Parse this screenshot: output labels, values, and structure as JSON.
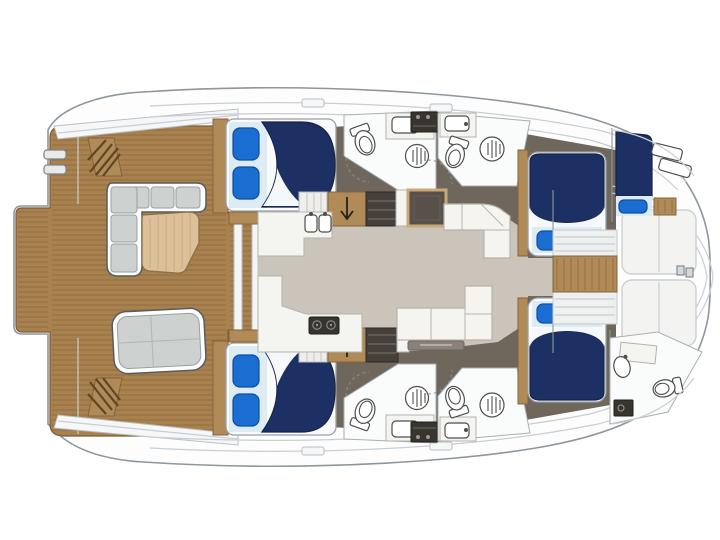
{
  "title": "Catamaran yacht interior deck plan (top view, bow to the right)",
  "colors": {
    "background": "#ffffff",
    "outline": "#8d969c",
    "hull-white": "#fdfdfd",
    "deck-line": "#c9ced2",
    "teak": "#a9814f",
    "teak-edge": "#7d5c33",
    "teak-line": "#6f5530",
    "salon-floor": "#cac4bb",
    "hull-floor": "#6f665c",
    "bath-floor": "#fafbfb",
    "wall-line": "#a9afb3",
    "fixture": "#4e4e4c",
    "counter": "#f4f4f0",
    "counter-edge": "#b4b4ad",
    "sofa-white": "#f5f4ef",
    "sofa-edge": "#b5b5ae",
    "cushion-gray": "#cdd1d0",
    "cushion-edge": "#9aa0a0",
    "frame-dark": "#585c5e",
    "navy": "#1d3063",
    "navy-edge": "#142348",
    "sheet": "#ddebf4",
    "sheet-fold": "#f4f8fb",
    "pillow": "#1a6ed2",
    "pillow-edge": "#0d4da0",
    "tan": "#b08a57",
    "tan-edge": "#84633a",
    "dark-shelf": "#46403a",
    "appliance": "#38352f",
    "bed-base": "#f8fafb",
    "bed-edge": "#98a0a5",
    "door-arc": "#8a9095",
    "tramp": "#f3f4f2",
    "tramp-edge": "#cbd0d2",
    "step-line": "#5e4724",
    "wood-table": "#dcc09a",
    "wood-table-edge": "#8a7046",
    "table-top": "#57514a",
    "table-frame": "#c9a877"
  },
  "plan": {
    "areas": [
      "aft-deck",
      "swim-platform",
      "cockpit-lounge",
      "salon",
      "galley",
      "port-aft-cabin",
      "port-aft-head",
      "port-fwd-head",
      "port-fwd-cabin",
      "starboard-aft-cabin",
      "starboard-aft-head",
      "starboard-fwd-head",
      "starboard-fwd-cabin",
      "forepeak-berth",
      "bow-head",
      "trampoline"
    ],
    "bed_count": 5,
    "head_count": 5
  }
}
